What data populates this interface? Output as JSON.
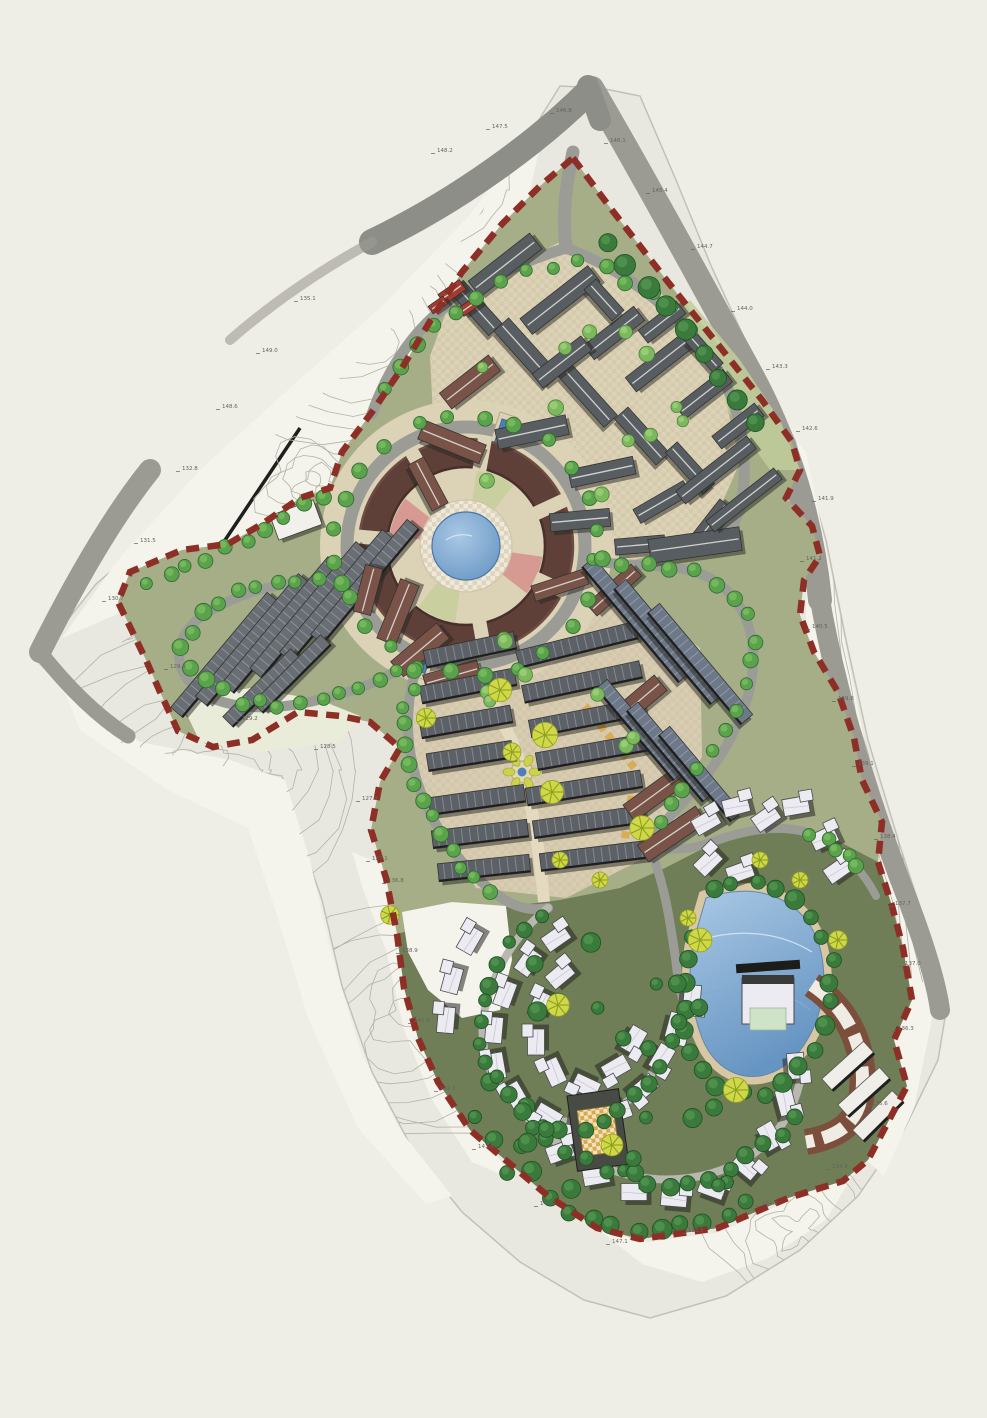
{
  "document": {
    "kind": "residential-resort-master-plan",
    "visible_title": ""
  },
  "palette": {
    "background": "#efeee6",
    "terrain": "#e9e8e0",
    "terrain_white": "#f4f3ec",
    "contour": "#b3b2a6",
    "edge_line": "#c2c1b8",
    "road_outer_dark": "#8e8e88",
    "road_outer": "#9b9a93",
    "road_inner": "#9c9c97",
    "road_minor": "#b9b8b0",
    "site_green": "#a5ae87",
    "site_green_light": "#c1cc9b",
    "site_olive": "#6f7e57",
    "boundary_red": "#8e2f27",
    "plaza_tan": "#dcd2b6",
    "plaza_tan2": "#d8cdb2",
    "plaza_light": "#efe9da",
    "plaza_pink": "#d69a92",
    "plaza_green": "#c9cf9f",
    "path_yellow": "#d9a94e",
    "roof_dark_gray": "#585d62",
    "roof_mid_gray": "#5c6167",
    "roof_terrace_west": "#686e74",
    "roof_terrace_east": "#6d7888",
    "roof_brown": "#7a5348",
    "roof_ring_maroon": "#5e4038",
    "roof_red": "#a33b30",
    "villa_white": "#ecebf1",
    "building_shadow": "#26261f",
    "water_light": "#a9c8e4",
    "water_deep": "#6795c3",
    "water_channel": "#4f7fb5",
    "beach_sand": "#d8c7a2",
    "tree_green": "#5aa24c",
    "tree_dark": "#3a7a3c",
    "tree_light": "#7cb95e",
    "tree_yellow": "#c9d23f",
    "label_gray": "#63635e",
    "wall_black": "#1f1f1d"
  },
  "features": {
    "central_plaza": "central circular plaza with pond",
    "lake": "south-east lake with clubhouse and pier",
    "boundary": "red dashed site boundary",
    "terraces_west": "west terraced housing rows",
    "terraces_east": "east terraced housing rows",
    "north_village": "north village blocks",
    "south_villas": "south hillside villas"
  },
  "elevation_markers": [
    "148.2",
    "147.5",
    "146.8",
    "146.1",
    "145.4",
    "144.7",
    "144.0",
    "143.3",
    "142.6",
    "141.9",
    "141.2",
    "140.5",
    "139.8",
    "139.1",
    "138.4",
    "137.7",
    "137.0",
    "136.3",
    "135.6",
    "134.9",
    "134.2",
    "133.5",
    "147.1",
    "145.9",
    "143.8",
    "142.1",
    "140.9",
    "138.9",
    "136.8",
    "135.1",
    "149.0",
    "148.6",
    "132.8",
    "131.5",
    "130.7",
    "129.9",
    "129.2",
    "128.5",
    "127.8",
    "127.1"
  ]
}
